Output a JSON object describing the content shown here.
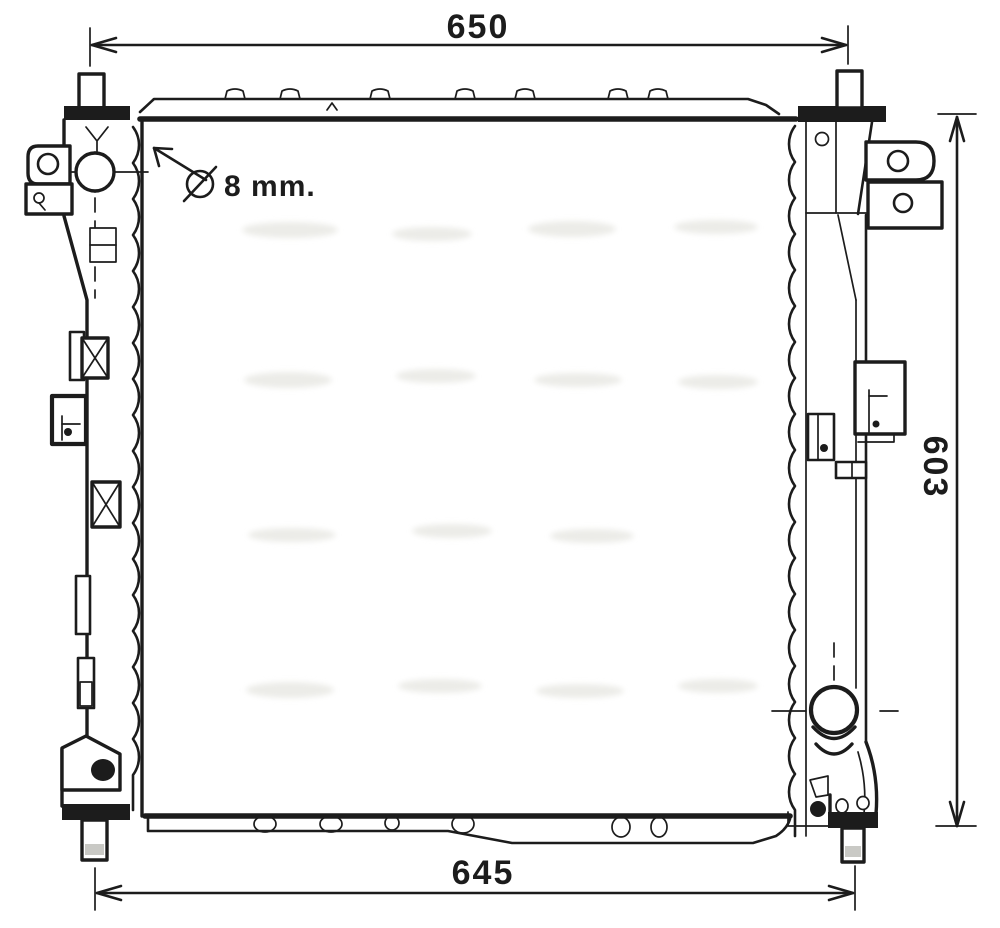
{
  "drawing_type": "radiator-outline-technical-drawing",
  "dimensions": {
    "top_width": "650",
    "bottom_width": "645",
    "right_height": "603"
  },
  "annotation": {
    "diameter_symbol": "⌀",
    "label": "8 mm.",
    "full_text": "⌀ 8 mm."
  },
  "colors": {
    "line": "#1c1c1c",
    "background": "#ffffff",
    "pin_highlight": "#c9c9c5",
    "grommet": "#1c1c1c",
    "watermark_smudge": "#e9e9e4"
  }
}
